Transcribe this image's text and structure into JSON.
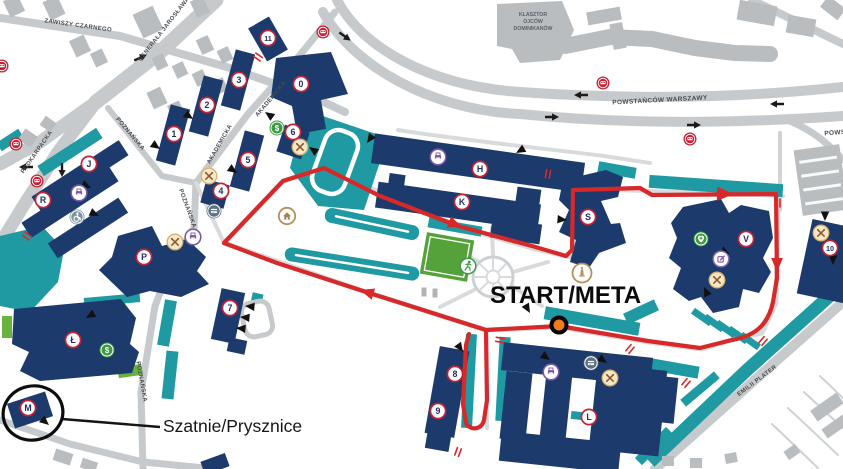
{
  "colors": {
    "building_navy": "#1c3a6b",
    "path_teal": "#1f9aa3",
    "route_red": "#d7282a",
    "start_dot_orange": "#f07b1a",
    "badge_ring_red": "#c22336",
    "road_gray": "#c7cacc",
    "minor_building_gray": "#b9bdc0",
    "field_green": "#55a23b"
  },
  "map": {
    "streets": [
      {
        "text": "ZAWISZY CZARNEGO",
        "x": 78,
        "y": 27,
        "rot": 8,
        "size": 6
      },
      {
        "text": "GENERAŁA JAROSŁAWA DĄB",
        "x": 170,
        "y": 24,
        "rot": -52,
        "size": 6
      },
      {
        "text": "PODKARPACKA",
        "x": 38,
        "y": 153,
        "rot": -55,
        "size": 6
      },
      {
        "text": "POZNAŃSKA",
        "x": 129,
        "y": 135,
        "rot": 50,
        "size": 6
      },
      {
        "text": "POZNAŃSKA",
        "x": 186,
        "y": 209,
        "rot": 70,
        "size": 6
      },
      {
        "text": "POZNAŃSKA",
        "x": 140,
        "y": 382,
        "rot": 80,
        "size": 6
      },
      {
        "text": "AKADEMICKA",
        "x": 221,
        "y": 145,
        "rot": -60,
        "size": 6
      },
      {
        "text": "AKADEMICKA",
        "x": 272,
        "y": 100,
        "rot": -50,
        "size": 6
      },
      {
        "text": "POWSTAŃCÓW WARSZAWY",
        "x": 660,
        "y": 102,
        "rot": -3,
        "size": 6.5
      },
      {
        "text": "POWSTAŃCÓW WARSZAWY",
        "x": 872,
        "y": 132,
        "rot": -4,
        "size": 6.5
      },
      {
        "text": "EMILII PLATER",
        "x": 758,
        "y": 382,
        "rot": -37,
        "size": 6,
        "fill": "#2c4a4d"
      }
    ],
    "landmark_label": {
      "lines": [
        "KLASZTOR",
        "OJCÓW",
        "DOMINIKANÓW"
      ],
      "x": 533,
      "y": 16,
      "size": 5.2,
      "line_h": 7
    },
    "badges": [
      {
        "label": "11",
        "x": 268,
        "y": 38
      },
      {
        "label": "0",
        "x": 301,
        "y": 84
      },
      {
        "label": "3",
        "x": 239,
        "y": 80
      },
      {
        "label": "2",
        "x": 207,
        "y": 105
      },
      {
        "label": "1",
        "x": 174,
        "y": 134
      },
      {
        "label": "5",
        "x": 248,
        "y": 160
      },
      {
        "label": "4",
        "x": 221,
        "y": 191
      },
      {
        "label": "6",
        "x": 293,
        "y": 132
      },
      {
        "label": "J",
        "x": 89,
        "y": 164
      },
      {
        "label": "R",
        "x": 43,
        "y": 200
      },
      {
        "label": "P",
        "x": 144,
        "y": 257
      },
      {
        "label": "Ł",
        "x": 73,
        "y": 340
      },
      {
        "label": "M",
        "x": 28,
        "y": 408
      },
      {
        "label": "7",
        "x": 230,
        "y": 308
      },
      {
        "label": "H",
        "x": 480,
        "y": 169
      },
      {
        "label": "K",
        "x": 462,
        "y": 202
      },
      {
        "label": "S",
        "x": 588,
        "y": 217
      },
      {
        "label": "V",
        "x": 746,
        "y": 239
      },
      {
        "label": "10",
        "x": 830,
        "y": 248
      },
      {
        "label": "8",
        "x": 455,
        "y": 374
      },
      {
        "label": "9",
        "x": 438,
        "y": 411
      },
      {
        "label": "L",
        "x": 589,
        "y": 417
      }
    ],
    "icons": [
      {
        "type": "bus-stop",
        "x": 2,
        "y": 66
      },
      {
        "type": "bus-stop",
        "x": 16,
        "y": 144
      },
      {
        "type": "bus-stop",
        "x": 37,
        "y": 181
      },
      {
        "type": "bus-stop",
        "x": 323,
        "y": 32
      },
      {
        "type": "bus-stop",
        "x": 603,
        "y": 83
      },
      {
        "type": "bus-stop",
        "x": 690,
        "y": 139
      },
      {
        "type": "atm",
        "x": 277,
        "y": 128
      },
      {
        "type": "atm",
        "x": 107,
        "y": 350
      },
      {
        "type": "first-aid",
        "x": 701,
        "y": 239
      },
      {
        "type": "runner",
        "x": 468,
        "y": 266
      },
      {
        "type": "food",
        "x": 300,
        "y": 147
      },
      {
        "type": "food",
        "x": 209,
        "y": 176
      },
      {
        "type": "food",
        "x": 175,
        "y": 242
      },
      {
        "type": "food",
        "x": 717,
        "y": 280
      },
      {
        "type": "food",
        "x": 821,
        "y": 233
      },
      {
        "type": "food",
        "x": 610,
        "y": 378
      },
      {
        "type": "print",
        "x": 79,
        "y": 193
      },
      {
        "type": "print",
        "x": 193,
        "y": 237
      },
      {
        "type": "print",
        "x": 438,
        "y": 157
      },
      {
        "type": "print",
        "x": 551,
        "y": 372
      },
      {
        "type": "cash-card",
        "x": 214,
        "y": 211
      },
      {
        "type": "cash-card",
        "x": 591,
        "y": 363
      },
      {
        "type": "wheelchair",
        "x": 77,
        "y": 217
      },
      {
        "type": "edit",
        "x": 721,
        "y": 259
      },
      {
        "type": "monument",
        "x": 582,
        "y": 273
      },
      {
        "type": "home",
        "x": 287,
        "y": 216
      }
    ],
    "direction_arrows": [
      {
        "x": 20,
        "y": 167,
        "rot": 180
      },
      {
        "x": 62,
        "y": 176,
        "rot": 90
      },
      {
        "x": 146,
        "y": 55,
        "rot": -25
      },
      {
        "x": 350,
        "y": 40,
        "rot": 35
      },
      {
        "x": 575,
        "y": 95,
        "rot": 180
      },
      {
        "x": 771,
        "y": 104,
        "rot": 180
      },
      {
        "x": 558,
        "y": 117,
        "rot": 0
      },
      {
        "x": 700,
        "y": 125,
        "rot": 0
      }
    ],
    "entrance_arrows": [
      {
        "x": 265,
        "y": 112,
        "rot": 215
      },
      {
        "x": 193,
        "y": 119,
        "rot": 35
      },
      {
        "x": 160,
        "y": 149,
        "rot": 35
      },
      {
        "x": 237,
        "y": 173,
        "rot": 35
      },
      {
        "x": 309,
        "y": 147,
        "rot": 215
      },
      {
        "x": 367,
        "y": 143,
        "rot": 125
      },
      {
        "x": 516,
        "y": 153,
        "rot": 150
      },
      {
        "x": 567,
        "y": 220,
        "rot": 5
      },
      {
        "x": 723,
        "y": 246,
        "rot": 255
      },
      {
        "x": 704,
        "y": 287,
        "rot": 245
      },
      {
        "x": 825,
        "y": 221,
        "rot": 90
      },
      {
        "x": 833,
        "y": 265,
        "rot": 90
      },
      {
        "x": 463,
        "y": 352,
        "rot": 55
      },
      {
        "x": 550,
        "y": 360,
        "rot": 35
      },
      {
        "x": 607,
        "y": 363,
        "rot": 35
      },
      {
        "x": 245,
        "y": 306,
        "rot": 185
      },
      {
        "x": 240,
        "y": 317,
        "rot": 185
      },
      {
        "x": 236,
        "y": 328,
        "rot": 185
      },
      {
        "x": 86,
        "y": 318,
        "rot": 150
      },
      {
        "x": 49,
        "y": 425,
        "rot": 40
      },
      {
        "x": 91,
        "y": 188,
        "rot": 25
      },
      {
        "x": 99,
        "y": 216,
        "rot": 25
      },
      {
        "x": 530,
        "y": 313,
        "rot": 60
      }
    ],
    "crossing_marks": [
      {
        "x": 258,
        "y": 57,
        "rot": 35
      },
      {
        "x": 27,
        "y": 236,
        "rot": 35
      },
      {
        "x": 548,
        "y": 174,
        "rot": 100
      },
      {
        "x": 630,
        "y": 349,
        "rot": 130
      },
      {
        "x": 686,
        "y": 383,
        "rot": 130
      },
      {
        "x": 763,
        "y": 341,
        "rot": 130
      },
      {
        "x": 458,
        "y": 452,
        "rot": 110
      },
      {
        "x": 500,
        "y": 340,
        "rot": 10
      },
      {
        "x": 778,
        "y": 203,
        "rot": 90
      }
    ],
    "route": {
      "color": "#d7282a",
      "main_path": "M224,243 L283,181 L324,168 L380,196 L458,226 L532,246 L566,256 L572,250 L573,190 L640,188 L652,195 L776,194 L777,278 L773,302 C768,325 755,336 732,340 L700,348 L648,341 L559,326 L486,330 L363,291 L277,263 Z",
      "spur_path": "M486,331 L487,400 L484,420 C482,430 470,431 466,423 L463,404 L466,345 L469,334",
      "arrowheads": [
        {
          "x": 360,
          "y": 290,
          "rot": 197,
          "len": 14
        },
        {
          "x": 462,
          "y": 227,
          "rot": 21,
          "len": 14
        },
        {
          "x": 734,
          "y": 194,
          "rot": 1,
          "len": 17
        },
        {
          "x": 777,
          "y": 272,
          "rot": 90,
          "len": 14
        }
      ]
    },
    "annotations": {
      "start_meta": {
        "text": "START/META",
        "x": 490,
        "y": 303,
        "size": 24,
        "dot": {
          "x": 559,
          "y": 325,
          "r": 7.5
        }
      },
      "locker_rooms": {
        "text": "Szatnie/Prysznice",
        "x": 163,
        "y": 432,
        "size": 17.5,
        "ellipse": {
          "cx": 33,
          "cy": 413,
          "rx": 30,
          "ry": 27,
          "rot": -12
        },
        "line": {
          "x1": 62,
          "y1": 419,
          "x2": 160,
          "y2": 427
        }
      }
    }
  }
}
